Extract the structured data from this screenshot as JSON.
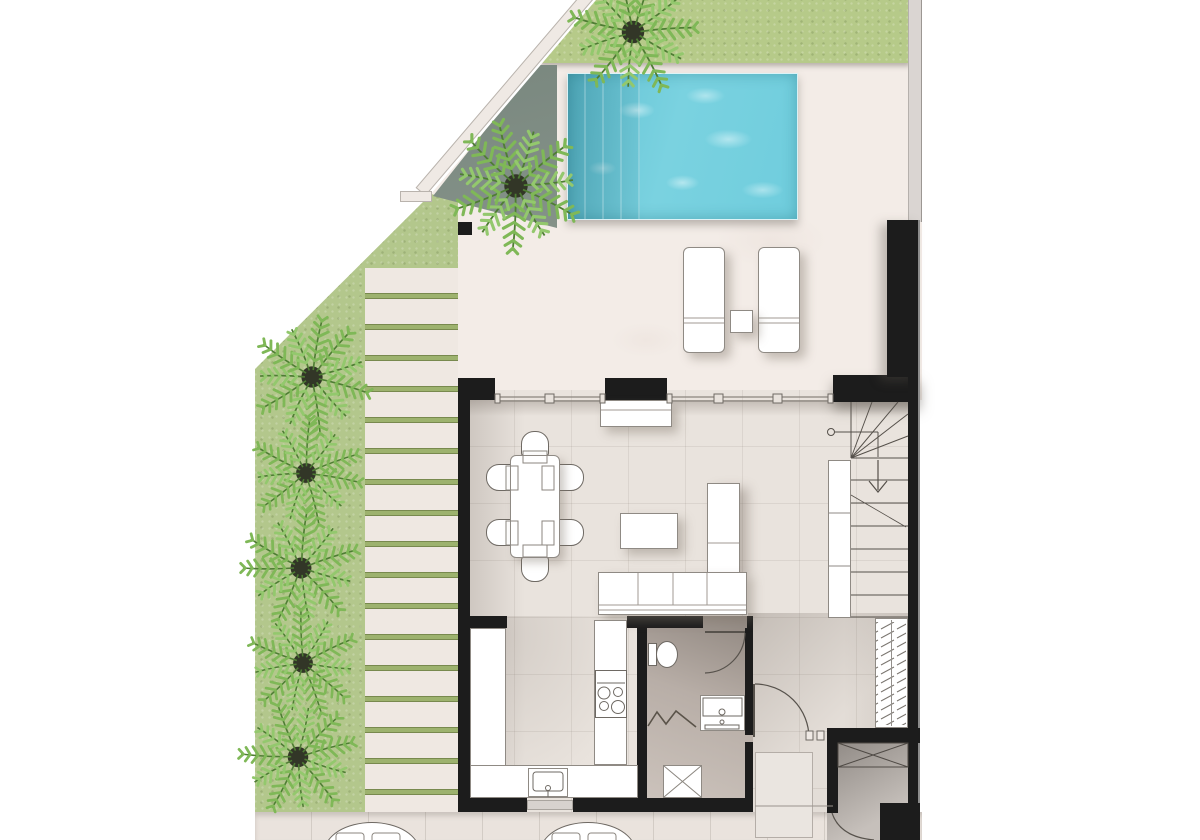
{
  "meta": {
    "type": "floor-plan",
    "view": "top-down architectural render",
    "level": "ground floor with pool garden"
  },
  "colors": {
    "grass": "#b3c78c",
    "grass_top": "#b6ca89",
    "deck": "#f3ece7",
    "stripe": "#efe8e2",
    "stripe_gap": "#9db26e",
    "stripe_edge": "#78894e",
    "hedge_dark": "#6f7d75",
    "hedge_light": "#b7c0ac",
    "pool": "#6fcddd",
    "pool_deep": "#57b9cb",
    "wall": "#1c1c1c",
    "wall_edge": "#8c8c8c",
    "floor": "#e9e3dd",
    "floor_corridor": "#ded7d1",
    "bath_dark": "#8f867f",
    "bath_light": "#ccc3bc",
    "room_dark": "#8f8984",
    "room_light": "#c6c0bb",
    "furniture": "#ffffff",
    "furniture_line": "#8f8a84",
    "line_dark": "#55504a",
    "line_mid": "#8a857e",
    "sidewalk": "#eae3dd",
    "boundary_band": "#efe9e4",
    "rug": "#eae5e0",
    "pot": "#323627",
    "frond_a": "#7fb857",
    "frond_b": "#93c86d",
    "stem": "#4e7d33"
  },
  "outdoor": {
    "pool": {
      "shape": "rectangular",
      "entry_steps": 4
    },
    "sun_loungers": 2,
    "lounger_side_table": 1,
    "palm_trees": 7,
    "terrace_deck_strips": 17,
    "lawn_areas": 3,
    "round_patio_tables": 2,
    "boundary": "diagonal white wall at top-left"
  },
  "rooms": [
    {
      "name": "living-dining",
      "furniture": [
        "dining table",
        "6 chairs",
        "sideboard",
        "coffee table",
        "L-shaped sofa with chaise"
      ]
    },
    {
      "name": "kitchen",
      "furniture": [
        "left counter run",
        "bottom counter",
        "right counter",
        "sink with faucet",
        "cooktop 4 burners",
        "window over sink"
      ]
    },
    {
      "name": "bathroom",
      "furniture": [
        "toilet",
        "vanity basin",
        "bi-fold shower door",
        "shower tray"
      ]
    },
    {
      "name": "staircase",
      "treads": 8,
      "winders": 4,
      "direction_arrow": "down",
      "storage_cabinet_segments": 3,
      "radiator_coil": 1
    },
    {
      "name": "hall-entry",
      "furniture": [
        "runner rug",
        "interior door",
        "front door"
      ]
    },
    {
      "name": "storage-room",
      "furniture": [
        "built-in closet marked with X"
      ]
    }
  ]
}
